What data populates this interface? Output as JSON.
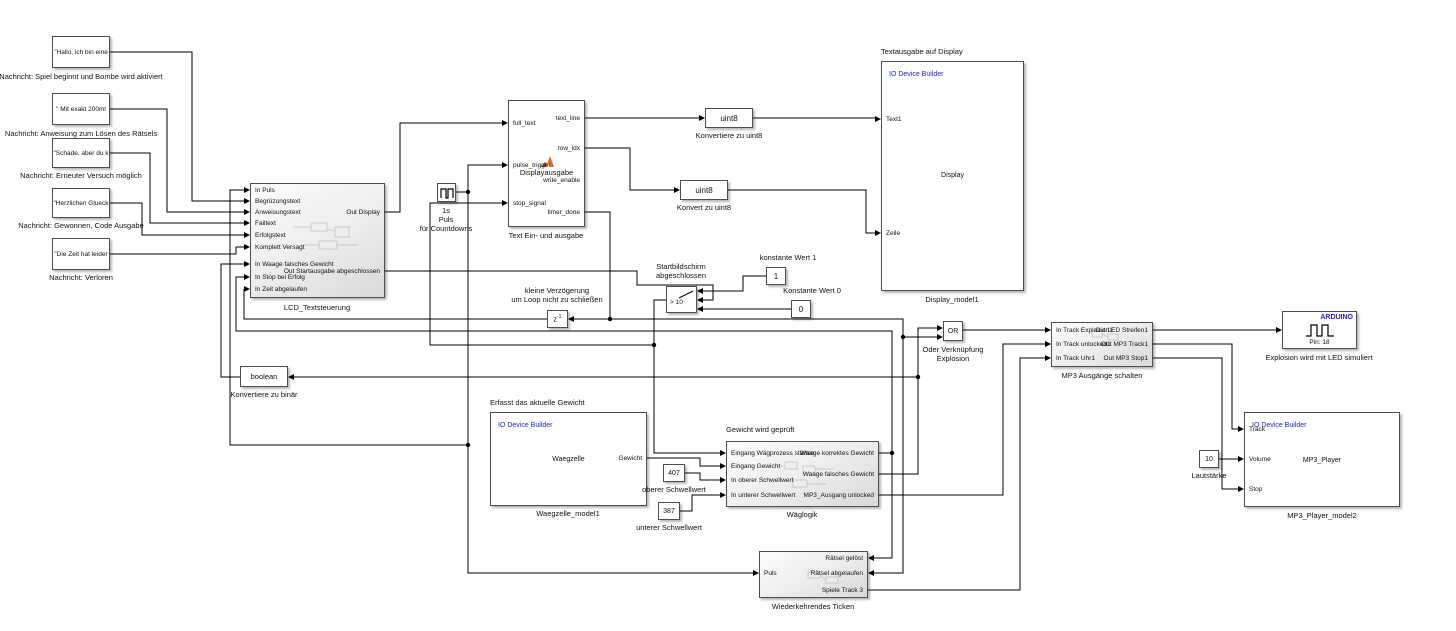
{
  "diagram_type": "simulink-block-diagram",
  "colors": {
    "builder_blue": "#2323cc",
    "arduino_blue": "#2323cc",
    "wire": "#000000",
    "matlab_orange": "#e06c1e"
  },
  "blocks": {
    "msg1": {
      "text": "\"Hallo, ich bin eine",
      "label": "Nachricht: Spiel beginnt und Bombe wird aktiviert"
    },
    "msg2": {
      "text": "\" Mit exakt 200ml",
      "label": "Nachricht: Anweisung zum Lösen des Rätsels"
    },
    "msg3": {
      "text": "\"Schade, aber du k",
      "label": "Nachricht: Erneuter Versuch möglich"
    },
    "msg4": {
      "text": "\"Herzlichen Glueck",
      "label": "Nachricht: Gewonnen, Code Ausgabe"
    },
    "msg5": {
      "text": "\"Die Zeit hat leider",
      "label": "Nachricht: Verloren"
    },
    "lcd": {
      "label": "LCD_Textsteuerung",
      "inputs": [
        "In Puls",
        "Begrüzungstext",
        "Anweisungstext",
        "Failtext",
        "Erfolgstext",
        "Komplett Versagt",
        "In Waage falsches Gewicht",
        "In Stop bei Erfolg",
        "In Zeit abgelaufen"
      ],
      "outputs": [
        "Out Display",
        "Out Startausgabe abgeschlossen"
      ]
    },
    "pulse": {
      "label1": "1s",
      "label2": "Puls",
      "label3": "für Countdowns"
    },
    "textio": {
      "label": "Text Ein- und ausgabe",
      "fn": "Displayausgabe",
      "inputs": [
        "full_text",
        "pulse_trigger",
        "stop_signal"
      ],
      "outputs": [
        "text_line",
        "row_idx",
        "write_enable",
        "timer_done"
      ]
    },
    "uint8a": {
      "text": "uint8",
      "label": "Konvertiere zu uint8"
    },
    "uint8b": {
      "text": "uint8",
      "label": "Konvert zu uint8"
    },
    "display": {
      "title": "Textausgabe auf Display",
      "builder": "IO Device Builder",
      "center": "Display",
      "label": "Display_model1",
      "inputs": [
        "Text1",
        "Zeile"
      ]
    },
    "delay": {
      "text": "z",
      "sup": "-1",
      "label1": "kleine Verzögerung",
      "label2": "um Loop nicht zu schließen"
    },
    "switch": {
      "title1": "Startbildschirm",
      "title2": "abgeschlossen",
      "criteria": "> 10"
    },
    "const1": {
      "value": "1",
      "label": "konstante Wert 1"
    },
    "const0": {
      "value": "0",
      "label": "Konstante Wert 0"
    },
    "or": {
      "text": "OR",
      "label1": "Oder Verknüpfung",
      "label2": "Explosion"
    },
    "mp3sw": {
      "label": "MP3 Ausgänge schalten",
      "inputs": [
        "In Track Explosion1",
        "In Track unlocked1",
        "In Track Uhr1"
      ],
      "outputs": [
        "Out LED Streifen1",
        "Out MP3 Track1",
        "Out MP3 Stop1"
      ]
    },
    "arduino": {
      "brand": "ARDUINO",
      "pin": "Pin: 18",
      "label": "Explosion wird mit LED simuliert"
    },
    "boolean": {
      "text": "boolean",
      "label": "Konvertiere zu binär"
    },
    "scale": {
      "title": "Erfasst das aktuelle Gewicht",
      "builder": "IO Device Builder",
      "center": "Waegzelle",
      "out": "Gewicht",
      "label": "Waegzelle_model1"
    },
    "c407": {
      "value": "407",
      "label": "oberer Schwellwert"
    },
    "c387": {
      "value": "387",
      "label": "unterer Schwellwert"
    },
    "wlogik": {
      "title": "Gewicht wird geprüft",
      "label": "Wäglogik",
      "inputs": [
        "Eingang Wägprozess starten",
        "Eingang Gewicht",
        "In oberer Schwellwert",
        "In unterer Schwellwert"
      ],
      "outputs": [
        "Waage korrektes Gewicht",
        "Waage falsches Gewicht",
        "MP3_Ausgang unlocked"
      ]
    },
    "c10": {
      "value": "10",
      "label": "Lautstärke"
    },
    "mp3p": {
      "builder": "IO Device Builder",
      "center": "MP3_Player",
      "label": "MP3_Player_model2",
      "inputs": [
        "Track",
        "Volume",
        "Stop"
      ]
    },
    "ticken": {
      "label": "Wiederkehrendes Ticken",
      "in_left": "Puls",
      "in_right": [
        "Rätsel gelöst",
        "Rätsel abgelaufen"
      ],
      "out": "Spiele Track 3"
    }
  }
}
